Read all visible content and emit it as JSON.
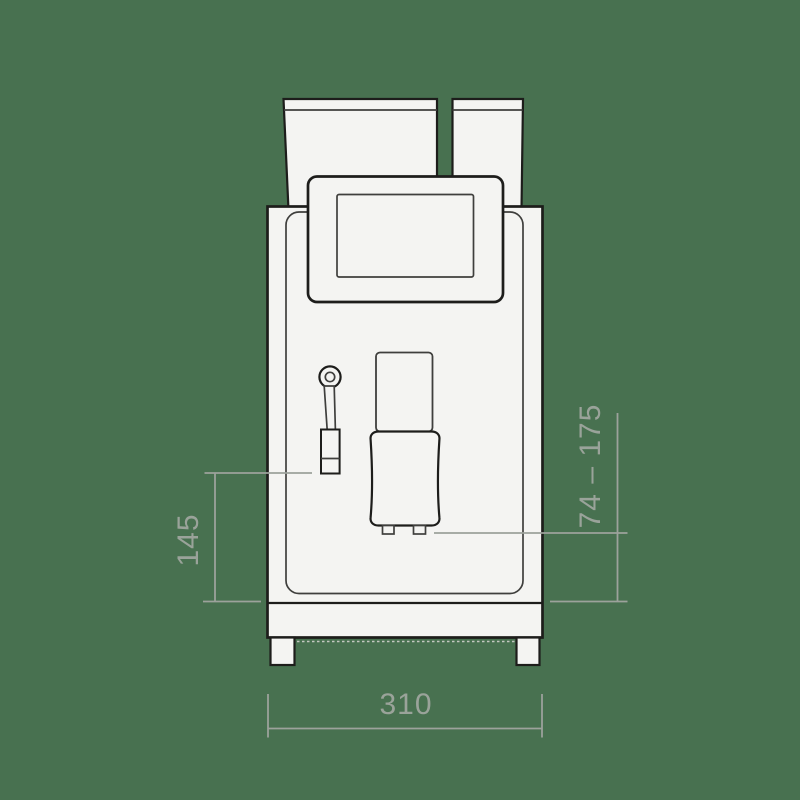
{
  "dimensions": {
    "left": {
      "value": "145"
    },
    "right": {
      "value": "74 – 175"
    },
    "bottom": {
      "value": "310"
    }
  },
  "colors": {
    "bg": "#487150",
    "ink": "#1d1d1b",
    "ink-soft": "#3f3f3d",
    "fill": "#f4f4f2",
    "faint": "#c4c8c2",
    "dim": "#9ca29b",
    "dim-text": "#9aa39a"
  }
}
